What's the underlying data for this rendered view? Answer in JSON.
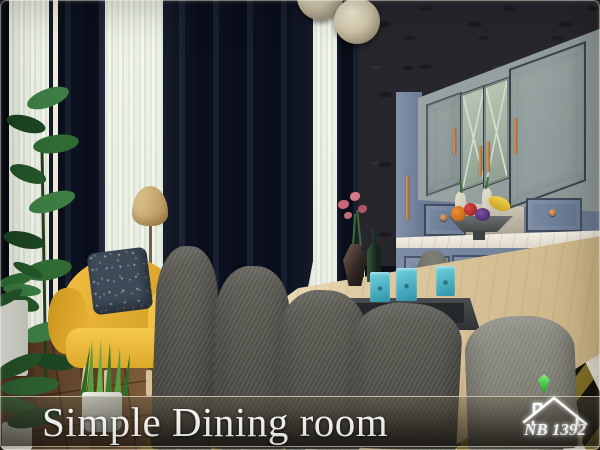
{
  "title": {
    "text": "Simple Dining room"
  },
  "watermark": {
    "text": "NB 1392",
    "icon": "plumbob-house-logo"
  },
  "colors": {
    "curtain_navy": "#0b101d",
    "sheer_light": "#eef3ec",
    "wallpaper_dark": "#26262c",
    "wallpaper_leaf": "#1a1a20",
    "cabinet_gray": "#8b9796",
    "sideboard_blue": "#68788f",
    "counter_marble": "#ddd6c6",
    "handle_copper": "#c48756",
    "table_wood": "#d6c196",
    "chair_dark": "#3f3e38",
    "chair_light": "#6b6a61",
    "armchair_yellow": "#e9b233",
    "pillow_navy": "#3e4a58",
    "lamp_shade": "#b39058",
    "pendant_cream": "#9a9179",
    "floor_wood": "#7b5634",
    "rug_black": "#14130e",
    "rug_white": "#e9e6da",
    "rug_olive": "#927f2c",
    "plant_green": "#2f6b33",
    "glass_teal": "#2e93a8",
    "flower_pink": "#cc6678",
    "bottle_green": "#15241a",
    "title_white": "#f7f6f2",
    "plumbob_green": "#16a016"
  }
}
